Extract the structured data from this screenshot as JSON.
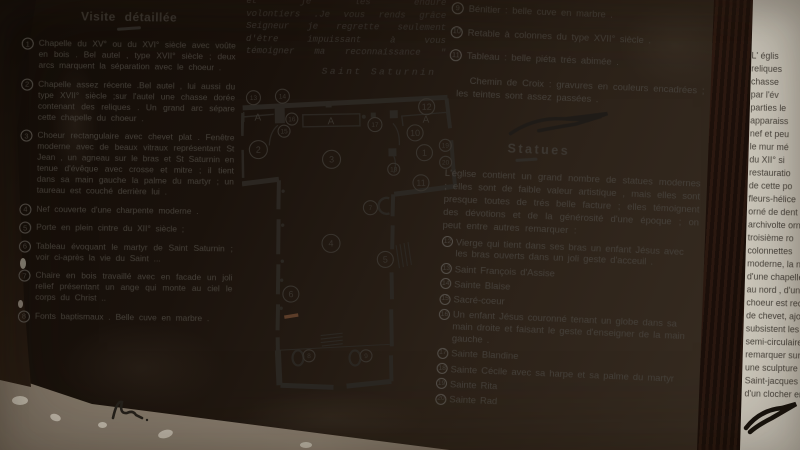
{
  "colors": {
    "paper": "#d8d5cb",
    "ink": "#45403a",
    "wood_frame": "#46281e",
    "ground": "#1a120c",
    "gravel": "#8d8172"
  },
  "panel": {
    "left_column": {
      "title": "Visite détaillée",
      "items": [
        {
          "num": "1",
          "text": "Chapelle du XV° ou du XVI° siècle avec voûte en bois . Bel autel , type XVII° siècle ; deux arcs marquent la séparation avec le choeur ."
        },
        {
          "num": "2",
          "text": "Chapelle assez récente .Bel autel , lui aussi du type XVII° siècle ;sur l'autel une chasse dorée contenant des reliques . Un grand arc sépare cette chapelle du choeur ."
        },
        {
          "num": "3",
          "text": "Choeur rectangulaire avec chevet plat . Fenêtre moderne avec de beaux vitraux représentant St Jean , un agneau sur le bras et St Saturnin en tenue d'évêque avec crosse et mitre ; il tient dans sa main gauche la palme du martyr ; un taureau est couché derrière lui ."
        },
        {
          "num": "4",
          "text": "Nef couverte d'une charpente moderne ."
        },
        {
          "num": "5",
          "text": "Porte en plein cintre du XII° siècle ;"
        },
        {
          "num": "6",
          "text": "Tableau évoquant le martyr de Saint Saturnin ; voir ci-après la vie du Saint ..."
        },
        {
          "num": "7",
          "text": "Chaire en bois travaillé avec en facade un joli relief présentant un ange qui monte au ciel le corps du Christ .."
        },
        {
          "num": "8",
          "text": "Fonts baptismaux . Belle cuve en marbre ."
        }
      ]
    },
    "quote": {
      "lines": [
        "et je les endure",
        "volontiers .Je vous rends grâce",
        "Seigneur je regrette seulement",
        "d'être impuissant à vous",
        "témoigner ma reconnaissance \""
      ],
      "caption": "Saint Saturnin"
    },
    "right_column": {
      "items": [
        {
          "num": "9",
          "text": "Bénitier : belle cuve en marbre ."
        },
        {
          "num": "10",
          "text": "Retable à colonnes du type XVII° siècle ."
        },
        {
          "num": "11",
          "text": "Tableau : belle piéta trés abimée ."
        }
      ],
      "chemin": "Chemin de Croix : gravures en couleurs encadrées ; les teintes sont assez passées .",
      "statues_heading": "Statues",
      "statues_intro": "L'église contient un grand nombre de statues modernes ; elles sont de faible valeur artistique , mais elles sont presque toutes de trés belle facture ; elles témoignent des dévotions et de la générosité d'une époque ; on peut entre autres remarquer :",
      "statues": [
        {
          "num": "12",
          "text": "Vierge qui tient dans ses bras un enfant Jésus avec les bras ouverts dans un joli geste d'acceuil ."
        },
        {
          "num": "13",
          "text": "Saint François d'Assise"
        },
        {
          "num": "14",
          "text": "Sainte Blaise"
        },
        {
          "num": "15",
          "text": "Sacré-coeur"
        },
        {
          "num": "16",
          "text": "Un enfant Jésus couronné tenant un globe dans sa main droite et faisant le geste d'enseigner de la main gauche ."
        },
        {
          "num": "17",
          "text": "Sainte Blandine"
        },
        {
          "num": "18",
          "text": "Sainte Cécile avec sa harpe et sa palme du martyr"
        },
        {
          "num": "19",
          "text": "Sainte Rita"
        },
        {
          "num": "20",
          "text": "Sainte Rad"
        }
      ]
    }
  },
  "plan": {
    "altar_letter": "A",
    "altars": [
      {
        "x": 17,
        "y": 33
      },
      {
        "x": 90,
        "y": 38
      },
      {
        "x": 185,
        "y": 38
      }
    ],
    "labels": [
      {
        "n": "1",
        "x": 183,
        "y": 68,
        "r": 8
      },
      {
        "n": "2",
        "x": 17,
        "y": 62,
        "r": 9
      },
      {
        "n": "3",
        "x": 90,
        "y": 73,
        "r": 9
      },
      {
        "n": "4",
        "x": 88,
        "y": 157,
        "r": 9
      },
      {
        "n": "5",
        "x": 142,
        "y": 174,
        "r": 8
      },
      {
        "n": "6",
        "x": 47,
        "y": 207,
        "r": 8
      },
      {
        "n": "7",
        "x": 128,
        "y": 122,
        "r": 7
      },
      {
        "n": "8",
        "x": 64,
        "y": 269,
        "r": 6
      },
      {
        "n": "9",
        "x": 121,
        "y": 270,
        "r": 6
      },
      {
        "n": "10",
        "x": 174,
        "y": 48,
        "r": 8
      },
      {
        "n": "11",
        "x": 179,
        "y": 98,
        "r": 8
      },
      {
        "n": "12",
        "x": 186,
        "y": 22,
        "r": 8
      },
      {
        "n": "13",
        "x": 13,
        "y": 10,
        "r": 7
      },
      {
        "n": "14",
        "x": 42,
        "y": 9,
        "r": 7
      },
      {
        "n": "15",
        "x": 43,
        "y": 44,
        "r": 6
      },
      {
        "n": "16",
        "x": 51,
        "y": 32,
        "r": 6
      },
      {
        "n": "17",
        "x": 134,
        "y": 39,
        "r": 7
      },
      {
        "n": "18",
        "x": 152,
        "y": 84,
        "r": 6
      },
      {
        "n": "19",
        "x": 204,
        "y": 61,
        "r": 6
      },
      {
        "n": "20",
        "x": 204,
        "y": 78,
        "r": 6
      }
    ]
  },
  "right_panel": {
    "fragments": [
      "L' églis",
      "reliques",
      "chasse",
      "par l'év",
      "parties le",
      "apparaiss",
      "nef et peu",
      "le mur mé",
      "du XII° si",
      "restauratio",
      "de cette po",
      "fleurs-hélice",
      "orné de dent",
      "archivolte orn",
      "troisième ro",
      "colonnettes",
      "moderne, la n",
      "d'une chapelle",
      "au nord , d'une",
      "choeur est recta",
      "de chevet, ajou",
      "subsistent les",
      "semi-circulaire",
      "remarquer sur le",
      "une sculpture",
      "Saint-jacques . Au",
      "d'un clocher en par"
    ]
  }
}
